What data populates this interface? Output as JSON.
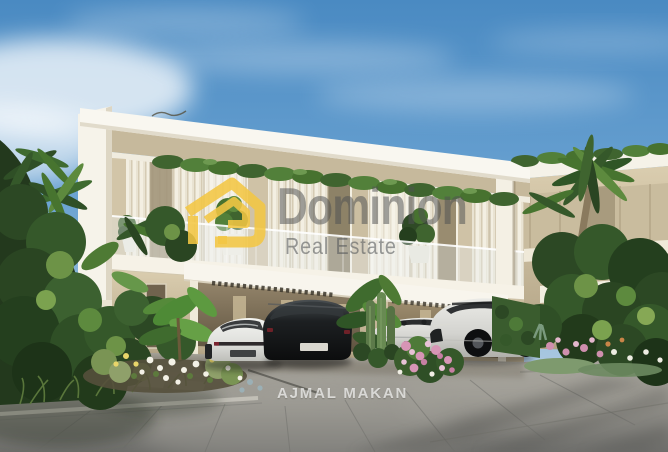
{
  "scene": {
    "kind": "real-estate architectural render",
    "setting": "Modern two-storey white villa with rooftop hedge and glass balcony, carport canopy, four luxury cars on a grey paved driveway, tropical landscaping, blue sky with light clouds",
    "objects": {
      "main_villa": "two-storey contemporary villa with curtained glass facade and carport",
      "second_villa": "matching villa partially visible behind palms on the right",
      "cars": [
        "white sports sedan (rear view)",
        "black luxury SUV (rear view)",
        "white convertible sports car",
        "white sports SUV (front view)"
      ],
      "vegetation": [
        "palm trees",
        "banana plants",
        "cacti",
        "flower beds white pink yellow",
        "rooftop greenery"
      ],
      "ground": "concrete driveway with plank pavers, stone curb and tree shadows"
    }
  },
  "watermark": {
    "brand_name": "Dominion",
    "brand_tagline": "Real Estate",
    "developer_mark": "AJMAL MAKAN",
    "logo_icon": "house-outline-icon"
  },
  "palette": {
    "sky_top": "#4a8ac2",
    "sky_light": "#cfe0ec",
    "villa_white": "#f8f5ed",
    "villa_beige": "#cfc2a6",
    "carport_shadow": "#6b5c45",
    "foliage_dark": "#22381c",
    "foliage_light": "#6d9347",
    "pavement_grey": "#97958f",
    "logo_yellow": "#f2c643",
    "watermark_grey": "#4e5153",
    "watermark_white": "#ffffff"
  }
}
